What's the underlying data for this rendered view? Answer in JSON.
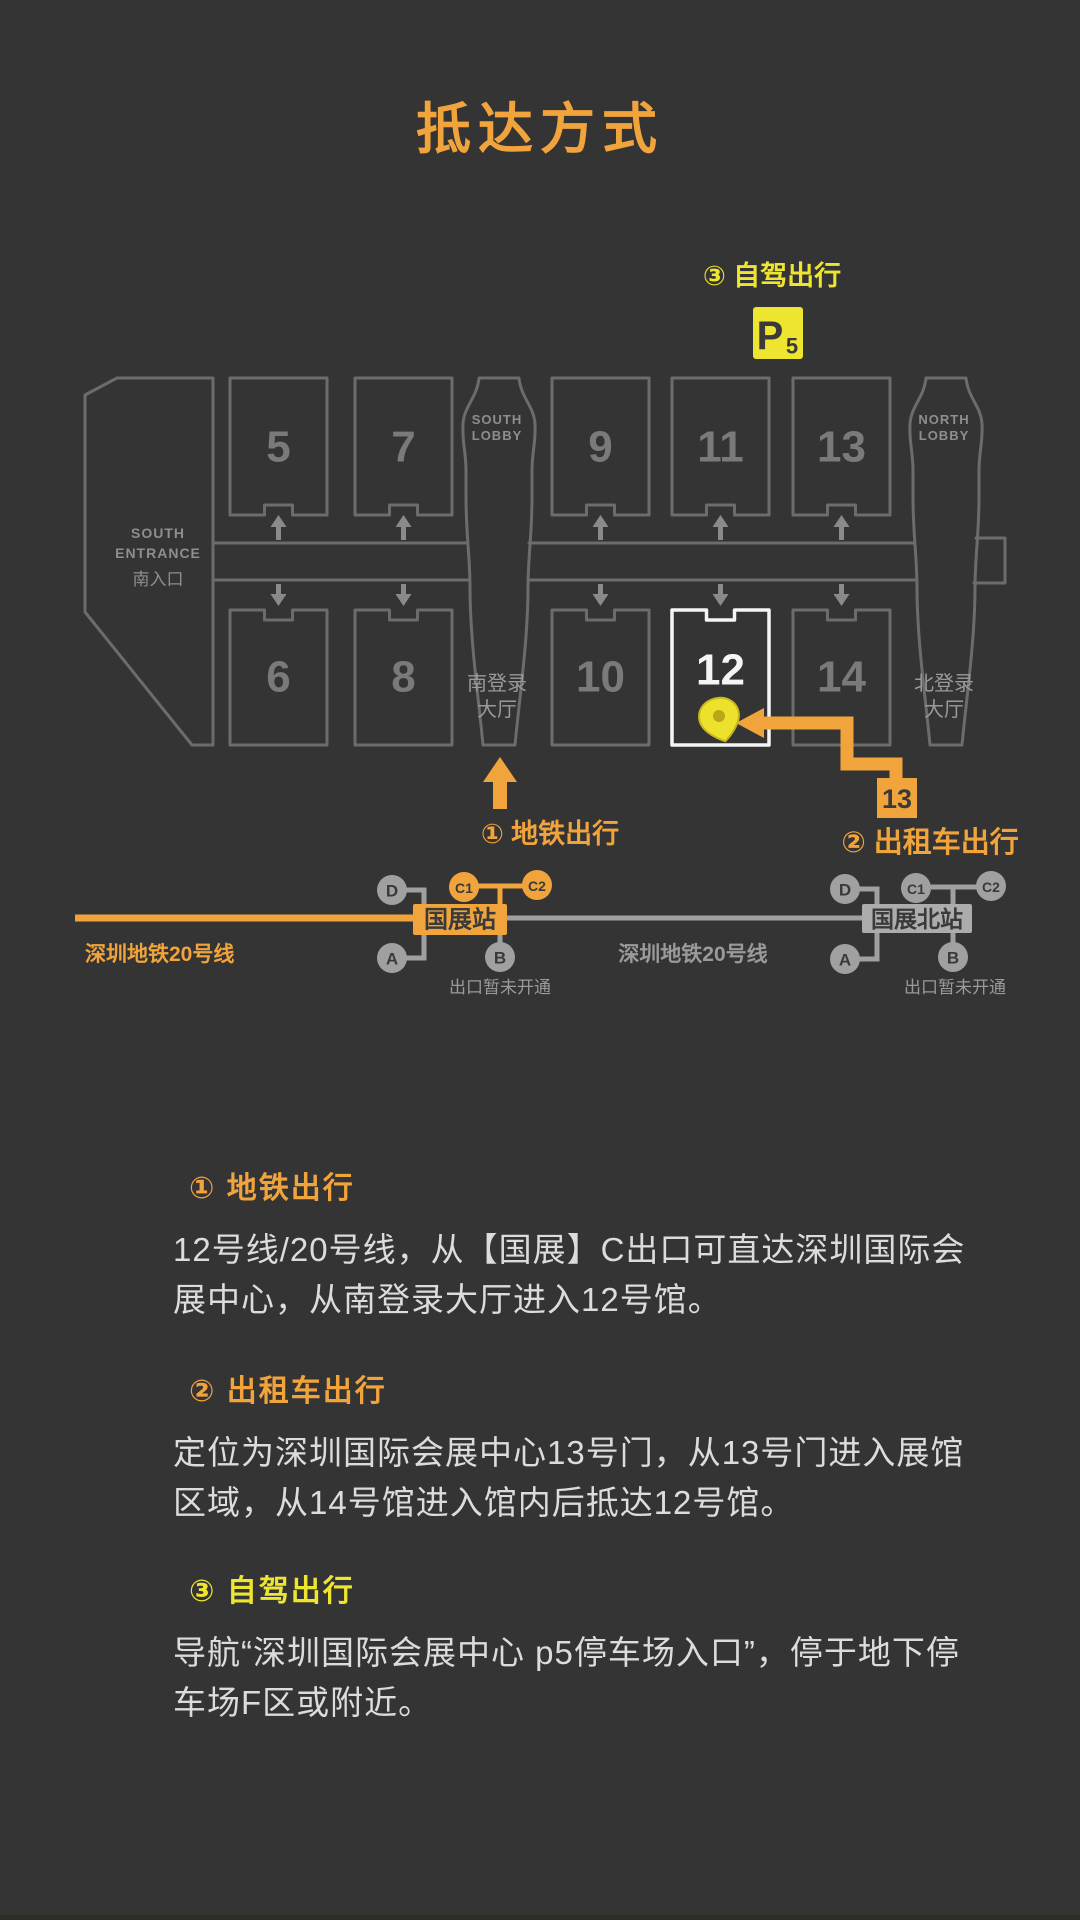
{
  "title": "抵达方式",
  "colors": {
    "background": "#343434",
    "accent_orange": "#F2A43C",
    "accent_yellow": "#EDE52F",
    "map_outline_gray": "#6C6C6C",
    "highlight_white": "#F5F5F5",
    "metro_gray": "#A0A0A0",
    "body_text": "#DCDCDC"
  },
  "map": {
    "south_entrance": [
      "SOUTH",
      "ENTRANCE",
      "南入口"
    ],
    "south_lobby": [
      "SOUTH",
      "LOBBY"
    ],
    "north_lobby": [
      "NORTH",
      "LOBBY"
    ],
    "south_reg": [
      "南登录",
      "大厅"
    ],
    "north_reg": [
      "北登录",
      "大厅"
    ],
    "halls_top": [
      "5",
      "7",
      "9",
      "11",
      "13"
    ],
    "halls_bottom": [
      "6",
      "8",
      "10",
      "12",
      "14"
    ],
    "highlighted_hall": "12",
    "parking_p": "P",
    "parking_5": "5",
    "gate13": "13"
  },
  "callouts": {
    "metro_arrow_label": "① 地铁出行",
    "taxi_label": "② 出租车出行",
    "car_label": "③ 自驾出行"
  },
  "metro": {
    "left_line_label": "深圳地铁20号线",
    "mid_line_label": "深圳地铁20号线",
    "station_left": "国展站",
    "station_right": "国展北站",
    "left_exits": {
      "D": "D",
      "A": "A",
      "B": "B",
      "C1": "C1",
      "C2": "C2"
    },
    "right_exits": {
      "D": "D",
      "A": "A",
      "B": "B",
      "C1": "C1",
      "C2": "C2"
    },
    "closed_note_left": "出口暂未开通",
    "closed_note_right": "出口暂未开通"
  },
  "sections": [
    {
      "heading": "① 地铁出行",
      "body": "12号线/20号线，从【国展】C出口可直达深圳国际会展中心，从南登录大厅进入12号馆。"
    },
    {
      "heading": "② 出租车出行",
      "body": "定位为深圳国际会展中心13号门，从13号门进入展馆区域，从14号馆进入馆内后抵达12号馆。"
    },
    {
      "heading": "③ 自驾出行",
      "body": "导航“深圳国际会展中心  p5停车场入口”，停于地下停车场F区或附近。"
    }
  ]
}
